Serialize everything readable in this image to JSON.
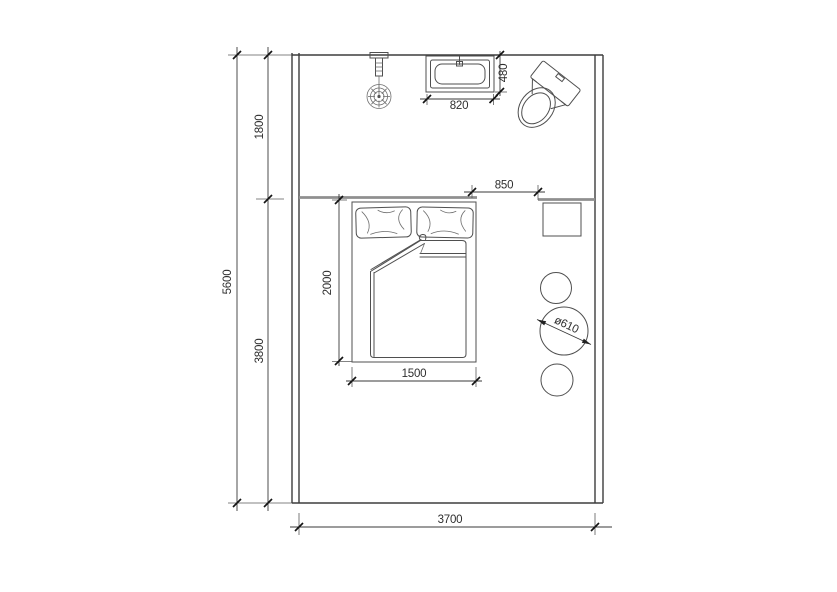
{
  "drawing": {
    "kind": "bedroom-with-bath-floor-plan",
    "unit": "mm"
  },
  "colors": {
    "background": "#ffffff",
    "line": "#4f4f4f",
    "wall": "#3d3d3d",
    "partition": "#8f8f8f",
    "dimension_text": "#2e2e2e"
  },
  "dimensions": {
    "total_depth": "5600",
    "bath_depth": "1800",
    "bedroom_depth": "3800",
    "room_width": "3700",
    "bed_length": "2000",
    "bed_width": "1500",
    "opening_width": "850",
    "sink_width": "820",
    "sink_depth": "480",
    "stool_diameter": "ø610"
  }
}
